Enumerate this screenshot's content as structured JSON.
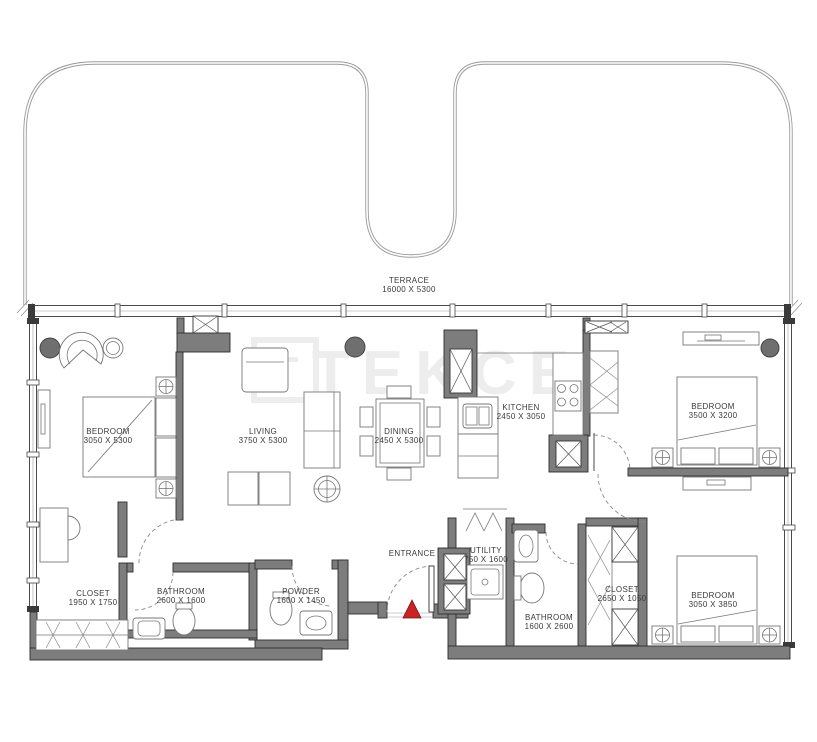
{
  "watermark": {
    "text": "TEKCE",
    "logo_letter": "T"
  },
  "terrace": {
    "name": "TERRACE",
    "dims": "16000 X 5300"
  },
  "entrance": {
    "label": "ENTRANCE"
  },
  "rooms": [
    {
      "id": "bedroom-1",
      "name": "BEDROOM",
      "dims": "3050 X 5300"
    },
    {
      "id": "living",
      "name": "LIVING",
      "dims": "3750 X 5300"
    },
    {
      "id": "dining",
      "name": "DINING",
      "dims": "2450 X 5300"
    },
    {
      "id": "kitchen",
      "name": "KITCHEN",
      "dims": "2450 X 3050"
    },
    {
      "id": "bedroom-2",
      "name": "BEDROOM",
      "dims": "3500 X 3200"
    },
    {
      "id": "bedroom-3",
      "name": "BEDROOM",
      "dims": "3050 X 3850"
    },
    {
      "id": "closet-1",
      "name": "CLOSET",
      "dims": "1950 X 1750"
    },
    {
      "id": "bathroom-1",
      "name": "BATHROOM",
      "dims": "2600 X 1600"
    },
    {
      "id": "powder",
      "name": "POWDER",
      "dims": "1600 X 1450"
    },
    {
      "id": "utility",
      "name": "UTILITY",
      "dims": "750 X 1600"
    },
    {
      "id": "bathroom-2",
      "name": "BATHROOM",
      "dims": "1600 X 2600"
    },
    {
      "id": "closet-2",
      "name": "CLOSET",
      "dims": "2650 X 1050"
    }
  ],
  "colors": {
    "background": "#ffffff",
    "wall_fill": "#7d7d7d",
    "wall_stroke": "#2e2e2e",
    "furniture_line": "#777777",
    "terrace_line": "#9b9b9b",
    "label_text": "#3a3a3a",
    "watermark": "#ededed",
    "entrance_marker": "#cc2222",
    "column_fill": "#6f6f6f"
  }
}
